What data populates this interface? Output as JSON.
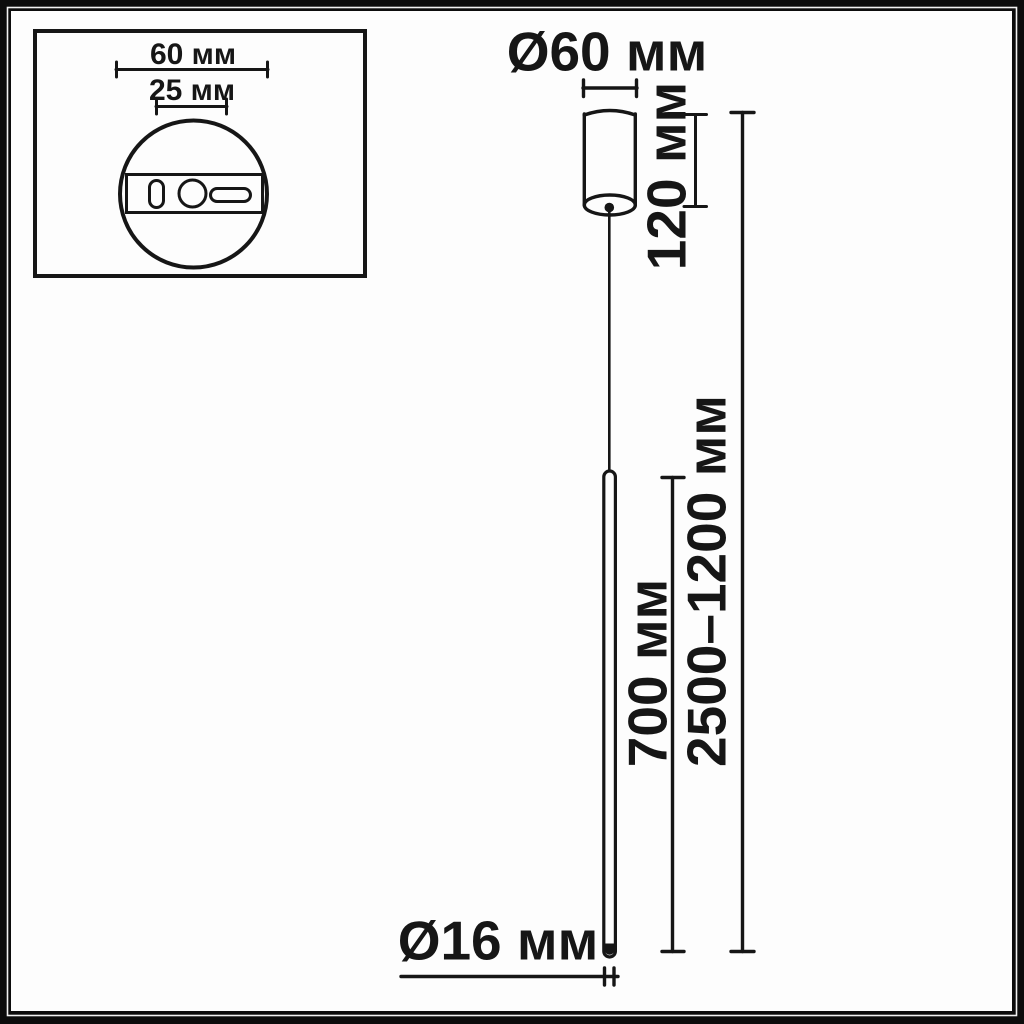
{
  "diagram": {
    "type": "pendant-lamp-dimension-drawing",
    "units": "мм"
  },
  "colors": {
    "ink": "#161616",
    "paper": "#fdfdfd",
    "frame": "#0c0c0c"
  },
  "inset": {
    "description": "ceiling-mount-plate-top-view",
    "plate_diameter_label": "60 мм",
    "mount_spacing_label": "25 мм"
  },
  "main": {
    "canopy_diameter_label": "Ø60 мм",
    "canopy_height_label": "120 мм",
    "lamp_length_label": "700 мм",
    "suspension_height_label": "2500–1200 мм",
    "rod_diameter_label": "Ø16 мм"
  }
}
